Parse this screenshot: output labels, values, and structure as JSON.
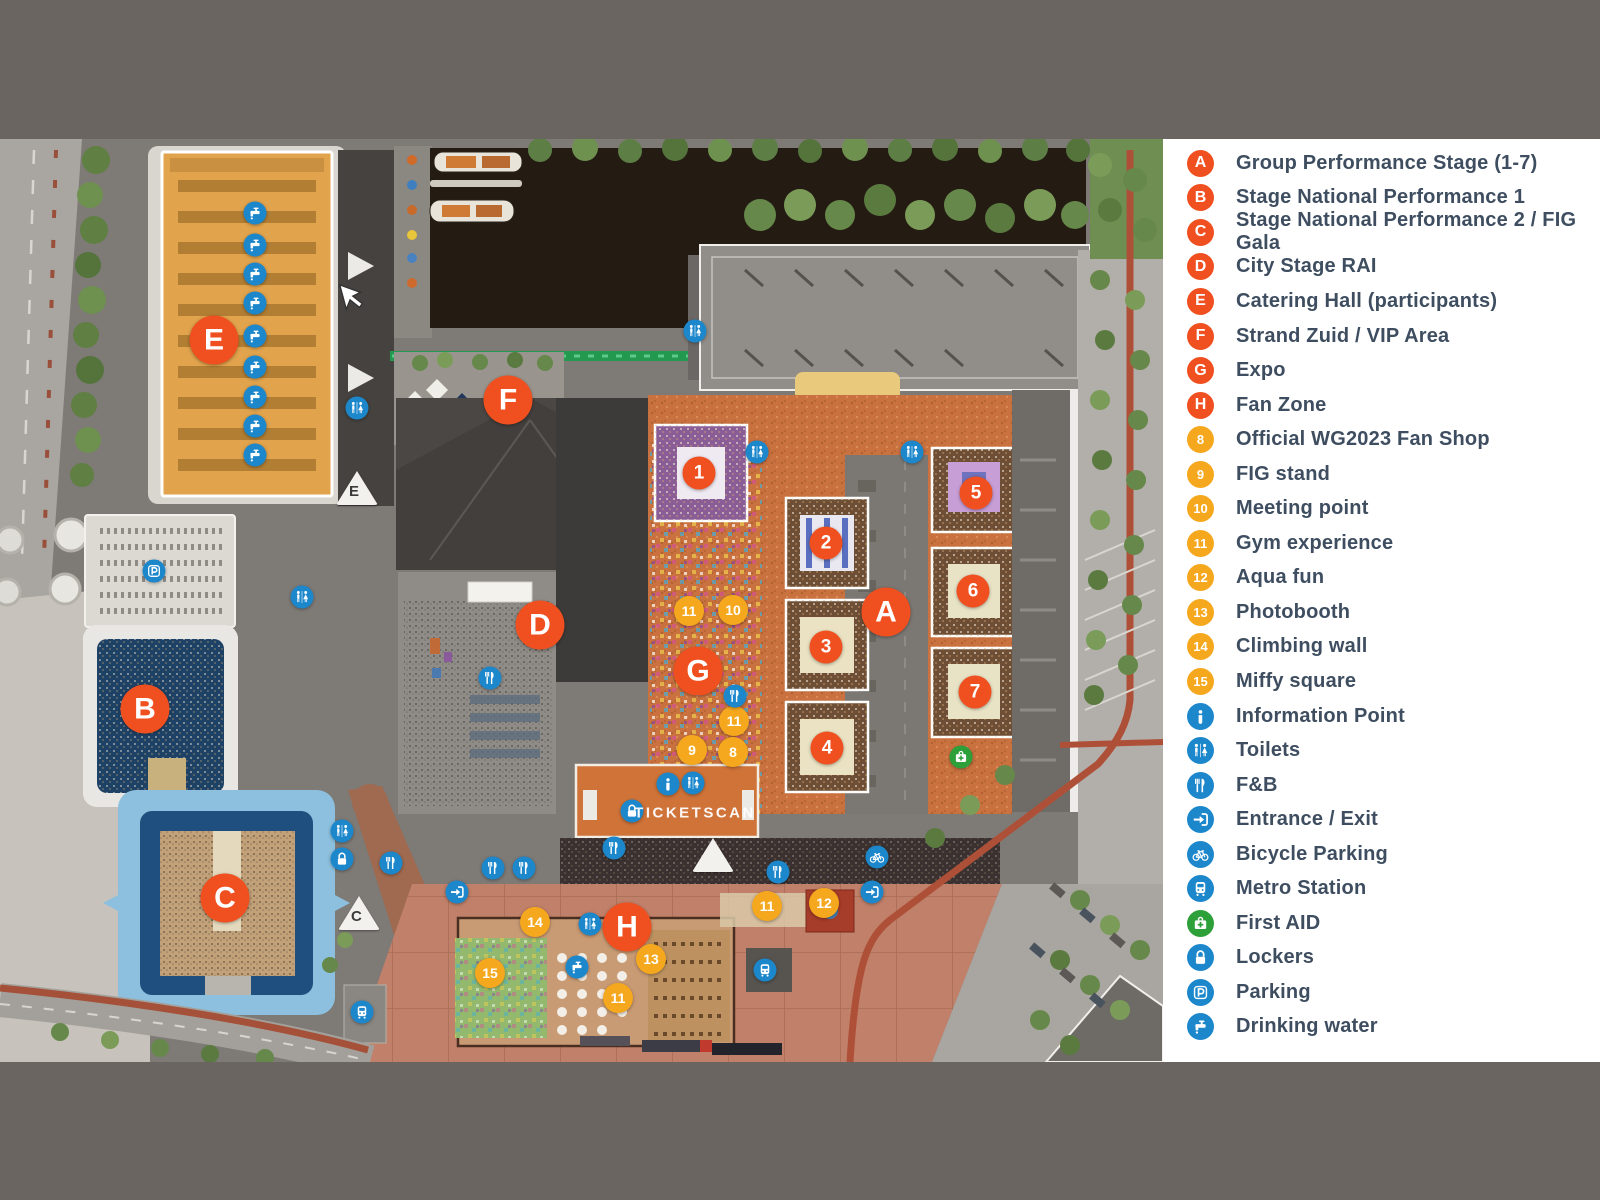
{
  "window": {
    "frame_color": "#6b6562",
    "legend_background": "#ffffff"
  },
  "colors": {
    "orange": "#f0501f",
    "yellow": "#f5a81d",
    "blue": "#1d87cc",
    "green": "#2da03a",
    "legend_text": "#3e4e60"
  },
  "legend": {
    "items": [
      {
        "kind": "letter",
        "symbol": "A",
        "label": "Group Performance Stage (1-7)"
      },
      {
        "kind": "letter",
        "symbol": "B",
        "label": "Stage National Performance 1"
      },
      {
        "kind": "letter",
        "symbol": "C",
        "label": "Stage National Performance 2 / FIG Gala"
      },
      {
        "kind": "letter",
        "symbol": "D",
        "label": "City Stage RAI"
      },
      {
        "kind": "letter",
        "symbol": "E",
        "label": "Catering Hall (participants)"
      },
      {
        "kind": "letter",
        "symbol": "F",
        "label": "Strand Zuid / VIP Area"
      },
      {
        "kind": "letter",
        "symbol": "G",
        "label": "Expo"
      },
      {
        "kind": "letter",
        "symbol": "H",
        "label": "Fan Zone"
      },
      {
        "kind": "number",
        "symbol": "8",
        "label": "Official WG2023 Fan Shop"
      },
      {
        "kind": "number",
        "symbol": "9",
        "label": "FIG stand"
      },
      {
        "kind": "number",
        "symbol": "10",
        "label": "Meeting point"
      },
      {
        "kind": "number",
        "symbol": "11",
        "label": "Gym experience"
      },
      {
        "kind": "number",
        "symbol": "12",
        "label": "Aqua fun"
      },
      {
        "kind": "number",
        "symbol": "13",
        "label": "Photobooth"
      },
      {
        "kind": "number",
        "symbol": "14",
        "label": "Climbing wall"
      },
      {
        "kind": "number",
        "symbol": "15",
        "label": "Miffy square"
      },
      {
        "kind": "icon",
        "icon": "info",
        "label": "Information Point"
      },
      {
        "kind": "icon",
        "icon": "toilets",
        "label": "Toilets"
      },
      {
        "kind": "icon",
        "icon": "fnb",
        "label": "F&B"
      },
      {
        "kind": "icon",
        "icon": "entrance",
        "label": "Entrance / Exit"
      },
      {
        "kind": "icon",
        "icon": "bicycle",
        "label": "Bicycle Parking"
      },
      {
        "kind": "icon",
        "icon": "metro",
        "label": "Metro Station"
      },
      {
        "kind": "icon",
        "icon": "firstaid",
        "color": "green",
        "label": "First AID"
      },
      {
        "kind": "icon",
        "icon": "lockers",
        "label": "Lockers"
      },
      {
        "kind": "icon",
        "icon": "parking",
        "label": "Parking"
      },
      {
        "kind": "icon",
        "icon": "water",
        "label": "Drinking water"
      }
    ]
  },
  "map": {
    "ticketscan_label": "TICKETSCAN",
    "ticketscan_pos": {
      "x": 695,
      "y": 813
    },
    "cursor": {
      "x": 336,
      "y": 283
    },
    "letter_markers": [
      {
        "label": "E",
        "x": 214,
        "y": 340
      },
      {
        "label": "F",
        "x": 508,
        "y": 400
      },
      {
        "label": "D",
        "x": 540,
        "y": 625
      },
      {
        "label": "B",
        "x": 145,
        "y": 709
      },
      {
        "label": "C",
        "x": 225,
        "y": 898
      },
      {
        "label": "A",
        "x": 886,
        "y": 612
      },
      {
        "label": "G",
        "x": 698,
        "y": 671
      },
      {
        "label": "H",
        "x": 627,
        "y": 927
      }
    ],
    "stage_markers": [
      {
        "label": "1",
        "x": 699,
        "y": 473
      },
      {
        "label": "2",
        "x": 826,
        "y": 543
      },
      {
        "label": "3",
        "x": 826,
        "y": 647
      },
      {
        "label": "4",
        "x": 827,
        "y": 748
      },
      {
        "label": "5",
        "x": 976,
        "y": 493
      },
      {
        "label": "6",
        "x": 973,
        "y": 591
      },
      {
        "label": "7",
        "x": 975,
        "y": 692
      }
    ],
    "poi_markers": [
      {
        "label": "11",
        "x": 689,
        "y": 611
      },
      {
        "label": "10",
        "x": 733,
        "y": 610
      },
      {
        "label": "11",
        "x": 734,
        "y": 721
      },
      {
        "label": "9",
        "x": 692,
        "y": 750
      },
      {
        "label": "8",
        "x": 733,
        "y": 752
      },
      {
        "label": "11",
        "x": 767,
        "y": 906
      },
      {
        "label": "12",
        "x": 824,
        "y": 903
      },
      {
        "label": "14",
        "x": 535,
        "y": 922
      },
      {
        "label": "13",
        "x": 651,
        "y": 959
      },
      {
        "label": "15",
        "x": 490,
        "y": 973
      },
      {
        "label": "11",
        "x": 618,
        "y": 998
      }
    ],
    "facility_markers": [
      {
        "icon": "water",
        "x": 255,
        "y": 213
      },
      {
        "icon": "water",
        "x": 255,
        "y": 245
      },
      {
        "icon": "water",
        "x": 255,
        "y": 274
      },
      {
        "icon": "water",
        "x": 255,
        "y": 303
      },
      {
        "icon": "water",
        "x": 255,
        "y": 336
      },
      {
        "icon": "water",
        "x": 255,
        "y": 367
      },
      {
        "icon": "water",
        "x": 255,
        "y": 397
      },
      {
        "icon": "water",
        "x": 255,
        "y": 426
      },
      {
        "icon": "water",
        "x": 255,
        "y": 455
      },
      {
        "icon": "water",
        "x": 577,
        "y": 967
      },
      {
        "icon": "toilets",
        "x": 357,
        "y": 408
      },
      {
        "icon": "toilets",
        "x": 695,
        "y": 331
      },
      {
        "icon": "toilets",
        "x": 302,
        "y": 597
      },
      {
        "icon": "toilets",
        "x": 757,
        "y": 452
      },
      {
        "icon": "toilets",
        "x": 912,
        "y": 452
      },
      {
        "icon": "toilets",
        "x": 693,
        "y": 783
      },
      {
        "icon": "toilets",
        "x": 342,
        "y": 831
      },
      {
        "icon": "toilets",
        "x": 590,
        "y": 924
      },
      {
        "icon": "fnb",
        "x": 490,
        "y": 678
      },
      {
        "icon": "fnb",
        "x": 735,
        "y": 696
      },
      {
        "icon": "fnb",
        "x": 614,
        "y": 848
      },
      {
        "icon": "fnb",
        "x": 493,
        "y": 868
      },
      {
        "icon": "fnb",
        "x": 524,
        "y": 868
      },
      {
        "icon": "fnb",
        "x": 778,
        "y": 872
      },
      {
        "icon": "fnb",
        "x": 391,
        "y": 863
      },
      {
        "icon": "info",
        "x": 668,
        "y": 784
      },
      {
        "icon": "lockers",
        "x": 632,
        "y": 811
      },
      {
        "icon": "lockers",
        "x": 342,
        "y": 859
      },
      {
        "icon": "parking",
        "x": 154,
        "y": 571
      },
      {
        "icon": "metro",
        "x": 362,
        "y": 1012
      },
      {
        "icon": "metro",
        "x": 765,
        "y": 970
      },
      {
        "icon": "bicycle",
        "x": 877,
        "y": 857
      },
      {
        "icon": "entrance",
        "x": 457,
        "y": 892
      },
      {
        "icon": "entrance",
        "x": 872,
        "y": 892
      },
      {
        "icon": "firstaid",
        "color": "green",
        "x": 961,
        "y": 757
      }
    ],
    "triangle_markers": [
      {
        "label": "E",
        "x": 357,
        "y": 488
      },
      {
        "label": "C",
        "x": 359,
        "y": 913
      },
      {
        "label": "",
        "x": 713,
        "y": 855
      }
    ]
  }
}
